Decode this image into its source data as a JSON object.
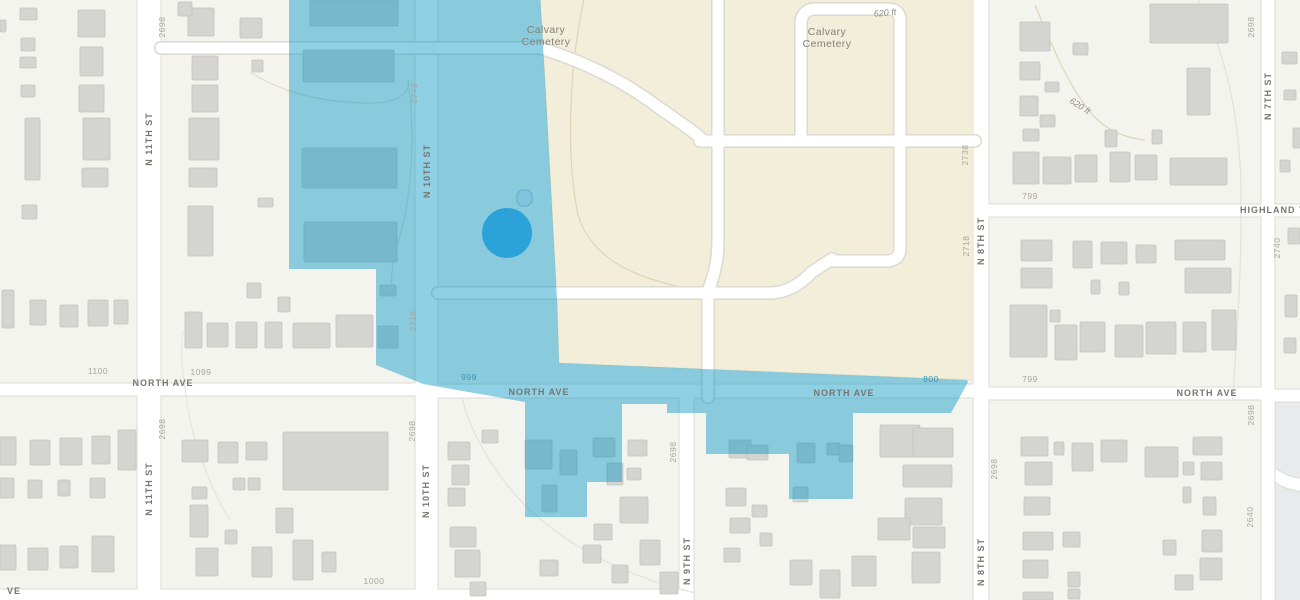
{
  "map": {
    "description": "Street basemap with Calvary Cemetery, a blue selection overlay polygon and a selected-location dot marker",
    "colors": {
      "block_fill": "#f4f4ef",
      "block_stroke": "#dddbd4",
      "road_fill": "#ffffff",
      "building_fill": "#d4d4d1",
      "building_stroke": "#c2c2bf",
      "cemetery_fill": "#f2eeda",
      "cemetery_stroke": "#e7e1c9",
      "contour_tan": "#ddd5b8",
      "contour_gray": "#e2e2dc",
      "overlay_blue": "#0094c3",
      "marker_blue": "#2ba3d8",
      "marker_blob_fill": "#7fc4dc",
      "marker_blob_stroke": "#63afc9",
      "park_fill": "#e7ebeb"
    },
    "labels": [
      {
        "text": "N 11TH ST",
        "x": 149,
        "y": 139,
        "rot": -90,
        "cls": "street",
        "name": "street-label-n-11th-st-top"
      },
      {
        "text": "N 11TH ST",
        "x": 149,
        "y": 489,
        "rot": -90,
        "cls": "street",
        "name": "street-label-n-11th-st-bottom"
      },
      {
        "text": "N 10TH ST",
        "x": 427,
        "y": 171,
        "rot": -90,
        "cls": "street",
        "name": "street-label-n-10th-st-top"
      },
      {
        "text": "N 10TH ST",
        "x": 426,
        "y": 491,
        "rot": -90,
        "cls": "street",
        "name": "street-label-n-10th-st-bottom"
      },
      {
        "text": "N 9TH ST",
        "x": 687,
        "y": 561,
        "rot": -90,
        "cls": "street",
        "name": "street-label-n-9th-st"
      },
      {
        "text": "N 8TH ST",
        "x": 981,
        "y": 241,
        "rot": -90,
        "cls": "street",
        "name": "street-label-n-8th-st-top"
      },
      {
        "text": "N 8TH ST",
        "x": 981,
        "y": 562,
        "rot": -90,
        "cls": "street",
        "name": "street-label-n-8th-st-bottom"
      },
      {
        "text": "N 7TH ST",
        "x": 1268,
        "y": 96,
        "rot": -90,
        "cls": "street",
        "name": "street-label-n-7th-st"
      },
      {
        "text": "NORTH AVE",
        "x": 163,
        "y": 383,
        "rot": 0,
        "cls": "street",
        "name": "street-label-north-ave-1"
      },
      {
        "text": "NORTH AVE",
        "x": 539,
        "y": 392,
        "rot": 0,
        "cls": "street",
        "name": "street-label-north-ave-2"
      },
      {
        "text": "NORTH AVE",
        "x": 844,
        "y": 393,
        "rot": 0,
        "cls": "street",
        "name": "street-label-north-ave-3"
      },
      {
        "text": "NORTH AVE",
        "x": 1207,
        "y": 393,
        "rot": 0,
        "cls": "street",
        "name": "street-label-north-ave-4"
      },
      {
        "text": "HIGHLAND TER",
        "x": 1280,
        "y": 210,
        "rot": 0,
        "cls": "street",
        "name": "street-label-highland-ter"
      },
      {
        "text": "VE",
        "x": 14,
        "y": 591,
        "rot": 0,
        "cls": "street",
        "name": "street-label-ve-partial"
      },
      {
        "text": "2698",
        "x": 163,
        "y": 27,
        "rot": -90,
        "cls": "num",
        "name": "parcel-number"
      },
      {
        "text": "2748",
        "x": 415,
        "y": 93,
        "rot": -90,
        "cls": "num",
        "name": "parcel-number"
      },
      {
        "text": "2718",
        "x": 414,
        "y": 321,
        "rot": -90,
        "cls": "num",
        "name": "parcel-number"
      },
      {
        "text": "2698",
        "x": 163,
        "y": 429,
        "rot": -90,
        "cls": "num",
        "name": "parcel-number"
      },
      {
        "text": "2698",
        "x": 413,
        "y": 431,
        "rot": -90,
        "cls": "num",
        "name": "parcel-number"
      },
      {
        "text": "2698",
        "x": 674,
        "y": 452,
        "rot": -90,
        "cls": "num",
        "name": "parcel-number"
      },
      {
        "text": "2698",
        "x": 995,
        "y": 469,
        "rot": -90,
        "cls": "num",
        "name": "parcel-number"
      },
      {
        "text": "2738",
        "x": 966,
        "y": 155,
        "rot": -90,
        "cls": "num",
        "name": "parcel-number"
      },
      {
        "text": "2718",
        "x": 967,
        "y": 246,
        "rot": -90,
        "cls": "num",
        "name": "parcel-number"
      },
      {
        "text": "2698",
        "x": 1252,
        "y": 27,
        "rot": -90,
        "cls": "num",
        "name": "parcel-number"
      },
      {
        "text": "2740",
        "x": 1278,
        "y": 248,
        "rot": -90,
        "cls": "num",
        "name": "parcel-number"
      },
      {
        "text": "2698",
        "x": 1252,
        "y": 415,
        "rot": -90,
        "cls": "num",
        "name": "parcel-number"
      },
      {
        "text": "2640",
        "x": 1251,
        "y": 517,
        "rot": -90,
        "cls": "num",
        "name": "parcel-number"
      },
      {
        "text": "1100",
        "x": 98,
        "y": 372,
        "rot": 0,
        "cls": "num",
        "name": "block-number"
      },
      {
        "text": "1099",
        "x": 201,
        "y": 373,
        "rot": 0,
        "cls": "num",
        "name": "block-number"
      },
      {
        "text": "799",
        "x": 1030,
        "y": 197,
        "rot": 0,
        "cls": "num",
        "name": "block-number"
      },
      {
        "text": "799",
        "x": 1030,
        "y": 380,
        "rot": 0,
        "cls": "num",
        "name": "block-number"
      },
      {
        "text": "1000",
        "x": 374,
        "y": 582,
        "rot": 0,
        "cls": "num",
        "name": "block-number"
      },
      {
        "text": "999",
        "x": 469,
        "y": 378,
        "rot": 0,
        "cls": "numblue",
        "name": "block-number-highlighted"
      },
      {
        "text": "800",
        "x": 931,
        "y": 380,
        "rot": 0,
        "cls": "numblue",
        "name": "block-number-highlighted"
      },
      {
        "text": "620 ft",
        "x": 885,
        "y": 13,
        "rot": -5,
        "cls": "contour",
        "name": "contour-elevation-label"
      },
      {
        "text": "620 ft",
        "x": 1080,
        "y": 106,
        "rot": 33,
        "cls": "contour",
        "name": "contour-elevation-label"
      },
      {
        "text": "Calvary\nCemetery",
        "x": 546,
        "y": 36,
        "rot": 0,
        "cls": "area",
        "name": "area-label-calvary-cemetery-west"
      },
      {
        "text": "Calvary\nCemetery",
        "x": 827,
        "y": 38,
        "rot": 0,
        "cls": "area",
        "name": "area-label-calvary-cemetery-east"
      }
    ],
    "buildings": [
      [
        20,
        8,
        17,
        12
      ],
      [
        21,
        38,
        14,
        13
      ],
      [
        20,
        57,
        16,
        11
      ],
      [
        21,
        85,
        14,
        12
      ],
      [
        0,
        20,
        6,
        12
      ],
      [
        78,
        10,
        27,
        27
      ],
      [
        80,
        47,
        23,
        29
      ],
      [
        79,
        85,
        25,
        27
      ],
      [
        83,
        118,
        27,
        42
      ],
      [
        82,
        168,
        26,
        19
      ],
      [
        25,
        118,
        15,
        62
      ],
      [
        22,
        205,
        15,
        14
      ],
      [
        2,
        290,
        12,
        38
      ],
      [
        30,
        300,
        16,
        25
      ],
      [
        60,
        305,
        18,
        22
      ],
      [
        88,
        300,
        20,
        26
      ],
      [
        114,
        300,
        14,
        24
      ],
      [
        188,
        8,
        26,
        28
      ],
      [
        240,
        18,
        22,
        20
      ],
      [
        178,
        2,
        14,
        14
      ],
      [
        192,
        56,
        26,
        24
      ],
      [
        192,
        85,
        26,
        27
      ],
      [
        189,
        118,
        30,
        42
      ],
      [
        189,
        168,
        28,
        19
      ],
      [
        188,
        206,
        25,
        50
      ],
      [
        258,
        198,
        15,
        9
      ],
      [
        247,
        283,
        14,
        15
      ],
      [
        278,
        297,
        12,
        15
      ],
      [
        252,
        60,
        11,
        12
      ],
      [
        185,
        312,
        17,
        36
      ],
      [
        207,
        323,
        21,
        24
      ],
      [
        236,
        322,
        21,
        26
      ],
      [
        265,
        322,
        17,
        26
      ],
      [
        293,
        323,
        37,
        25
      ],
      [
        336,
        315,
        37,
        32
      ],
      [
        310,
        0,
        88,
        26
      ],
      [
        303,
        50,
        91,
        32
      ],
      [
        302,
        148,
        95,
        40
      ],
      [
        304,
        222,
        93,
        40
      ],
      [
        380,
        285,
        16,
        11
      ],
      [
        378,
        326,
        20,
        22
      ],
      [
        0,
        437,
        16,
        28
      ],
      [
        30,
        440,
        20,
        25
      ],
      [
        60,
        438,
        22,
        27
      ],
      [
        92,
        436,
        18,
        28
      ],
      [
        118,
        430,
        18,
        40
      ],
      [
        0,
        478,
        14,
        20
      ],
      [
        28,
        480,
        14,
        18
      ],
      [
        58,
        480,
        12,
        16
      ],
      [
        90,
        478,
        15,
        20
      ],
      [
        0,
        545,
        16,
        25
      ],
      [
        28,
        548,
        20,
        22
      ],
      [
        60,
        546,
        18,
        22
      ],
      [
        92,
        536,
        22,
        36
      ],
      [
        182,
        440,
        26,
        22
      ],
      [
        218,
        442,
        20,
        21
      ],
      [
        246,
        442,
        21,
        18
      ],
      [
        283,
        432,
        105,
        58
      ],
      [
        192,
        487,
        15,
        12
      ],
      [
        233,
        478,
        12,
        12
      ],
      [
        248,
        478,
        12,
        12
      ],
      [
        190,
        505,
        18,
        32
      ],
      [
        276,
        508,
        17,
        25
      ],
      [
        225,
        530,
        12,
        14
      ],
      [
        196,
        548,
        22,
        28
      ],
      [
        252,
        547,
        20,
        30
      ],
      [
        293,
        540,
        20,
        40
      ],
      [
        322,
        552,
        14,
        20
      ],
      [
        448,
        442,
        22,
        18
      ],
      [
        452,
        465,
        17,
        20
      ],
      [
        448,
        488,
        17,
        18
      ],
      [
        482,
        430,
        16,
        13
      ],
      [
        450,
        527,
        26,
        20
      ],
      [
        455,
        550,
        25,
        27
      ],
      [
        470,
        582,
        16,
        14
      ],
      [
        628,
        440,
        19,
        16
      ],
      [
        627,
        468,
        14,
        12
      ],
      [
        620,
        497,
        28,
        26
      ],
      [
        594,
        524,
        18,
        16
      ],
      [
        583,
        545,
        18,
        18
      ],
      [
        640,
        540,
        20,
        25
      ],
      [
        612,
        565,
        16,
        18
      ],
      [
        660,
        572,
        18,
        22
      ],
      [
        540,
        560,
        18,
        16
      ],
      [
        525,
        440,
        27,
        29
      ],
      [
        560,
        450,
        17,
        25
      ],
      [
        593,
        438,
        22,
        19
      ],
      [
        607,
        463,
        16,
        22
      ],
      [
        542,
        485,
        15,
        27
      ],
      [
        729,
        440,
        22,
        18
      ],
      [
        747,
        445,
        21,
        15
      ],
      [
        797,
        443,
        18,
        20
      ],
      [
        827,
        443,
        13,
        12
      ],
      [
        839,
        445,
        14,
        17
      ],
      [
        793,
        487,
        15,
        15
      ],
      [
        880,
        425,
        40,
        32
      ],
      [
        913,
        428,
        40,
        29
      ],
      [
        903,
        465,
        49,
        22
      ],
      [
        905,
        498,
        37,
        27
      ],
      [
        913,
        527,
        32,
        21
      ],
      [
        912,
        552,
        28,
        31
      ],
      [
        726,
        488,
        20,
        18
      ],
      [
        752,
        505,
        15,
        12
      ],
      [
        730,
        518,
        20,
        15
      ],
      [
        724,
        548,
        16,
        14
      ],
      [
        760,
        533,
        12,
        13
      ],
      [
        790,
        560,
        22,
        25
      ],
      [
        820,
        570,
        20,
        28
      ],
      [
        852,
        556,
        24,
        30
      ],
      [
        878,
        518,
        32,
        22
      ],
      [
        1020,
        22,
        30,
        29
      ],
      [
        1073,
        43,
        15,
        12
      ],
      [
        1020,
        62,
        20,
        18
      ],
      [
        1045,
        82,
        14,
        10
      ],
      [
        1020,
        96,
        18,
        20
      ],
      [
        1040,
        115,
        15,
        12
      ],
      [
        1023,
        129,
        16,
        12
      ],
      [
        1150,
        4,
        78,
        39
      ],
      [
        1187,
        68,
        23,
        47
      ],
      [
        1105,
        130,
        12,
        17
      ],
      [
        1152,
        130,
        10,
        14
      ],
      [
        1013,
        152,
        26,
        32
      ],
      [
        1043,
        157,
        28,
        27
      ],
      [
        1075,
        155,
        22,
        27
      ],
      [
        1110,
        152,
        20,
        30
      ],
      [
        1135,
        155,
        22,
        25
      ],
      [
        1170,
        158,
        57,
        27
      ],
      [
        1021,
        240,
        31,
        21
      ],
      [
        1073,
        241,
        19,
        27
      ],
      [
        1101,
        242,
        26,
        22
      ],
      [
        1136,
        245,
        20,
        18
      ],
      [
        1175,
        240,
        50,
        20
      ],
      [
        1021,
        268,
        31,
        20
      ],
      [
        1091,
        280,
        9,
        14
      ],
      [
        1119,
        282,
        10,
        13
      ],
      [
        1185,
        268,
        46,
        25
      ],
      [
        1010,
        305,
        37,
        52
      ],
      [
        1050,
        310,
        10,
        12
      ],
      [
        1055,
        325,
        22,
        35
      ],
      [
        1080,
        322,
        25,
        30
      ],
      [
        1115,
        325,
        28,
        32
      ],
      [
        1146,
        322,
        30,
        32
      ],
      [
        1183,
        322,
        23,
        30
      ],
      [
        1212,
        310,
        24,
        40
      ],
      [
        1021,
        437,
        27,
        19
      ],
      [
        1054,
        442,
        10,
        13
      ],
      [
        1072,
        443,
        21,
        28
      ],
      [
        1101,
        440,
        26,
        22
      ],
      [
        1145,
        447,
        33,
        30
      ],
      [
        1183,
        462,
        11,
        13
      ],
      [
        1193,
        437,
        29,
        18
      ],
      [
        1201,
        462,
        21,
        18
      ],
      [
        1183,
        487,
        8,
        16
      ],
      [
        1203,
        497,
        13,
        18
      ],
      [
        1025,
        462,
        27,
        23
      ],
      [
        1024,
        497,
        26,
        18
      ],
      [
        1063,
        532,
        17,
        15
      ],
      [
        1023,
        532,
        30,
        18
      ],
      [
        1023,
        560,
        25,
        18
      ],
      [
        1068,
        572,
        12,
        15
      ],
      [
        1068,
        589,
        12,
        10
      ],
      [
        1163,
        540,
        13,
        15
      ],
      [
        1202,
        530,
        20,
        22
      ],
      [
        1175,
        575,
        18,
        15
      ],
      [
        1200,
        558,
        22,
        22
      ],
      [
        1023,
        592,
        30,
        8
      ],
      [
        1282,
        52,
        15,
        12
      ],
      [
        1284,
        90,
        12,
        10
      ],
      [
        1293,
        128,
        12,
        20
      ],
      [
        1280,
        160,
        10,
        12
      ],
      [
        1288,
        228,
        12,
        16
      ],
      [
        1285,
        295,
        12,
        22
      ],
      [
        1284,
        338,
        12,
        15
      ]
    ],
    "selection": {
      "marker": {
        "cx": 507,
        "cy": 233,
        "r": 25
      },
      "blob": {
        "cx": 524,
        "cy": 198,
        "r": 9
      }
    }
  }
}
